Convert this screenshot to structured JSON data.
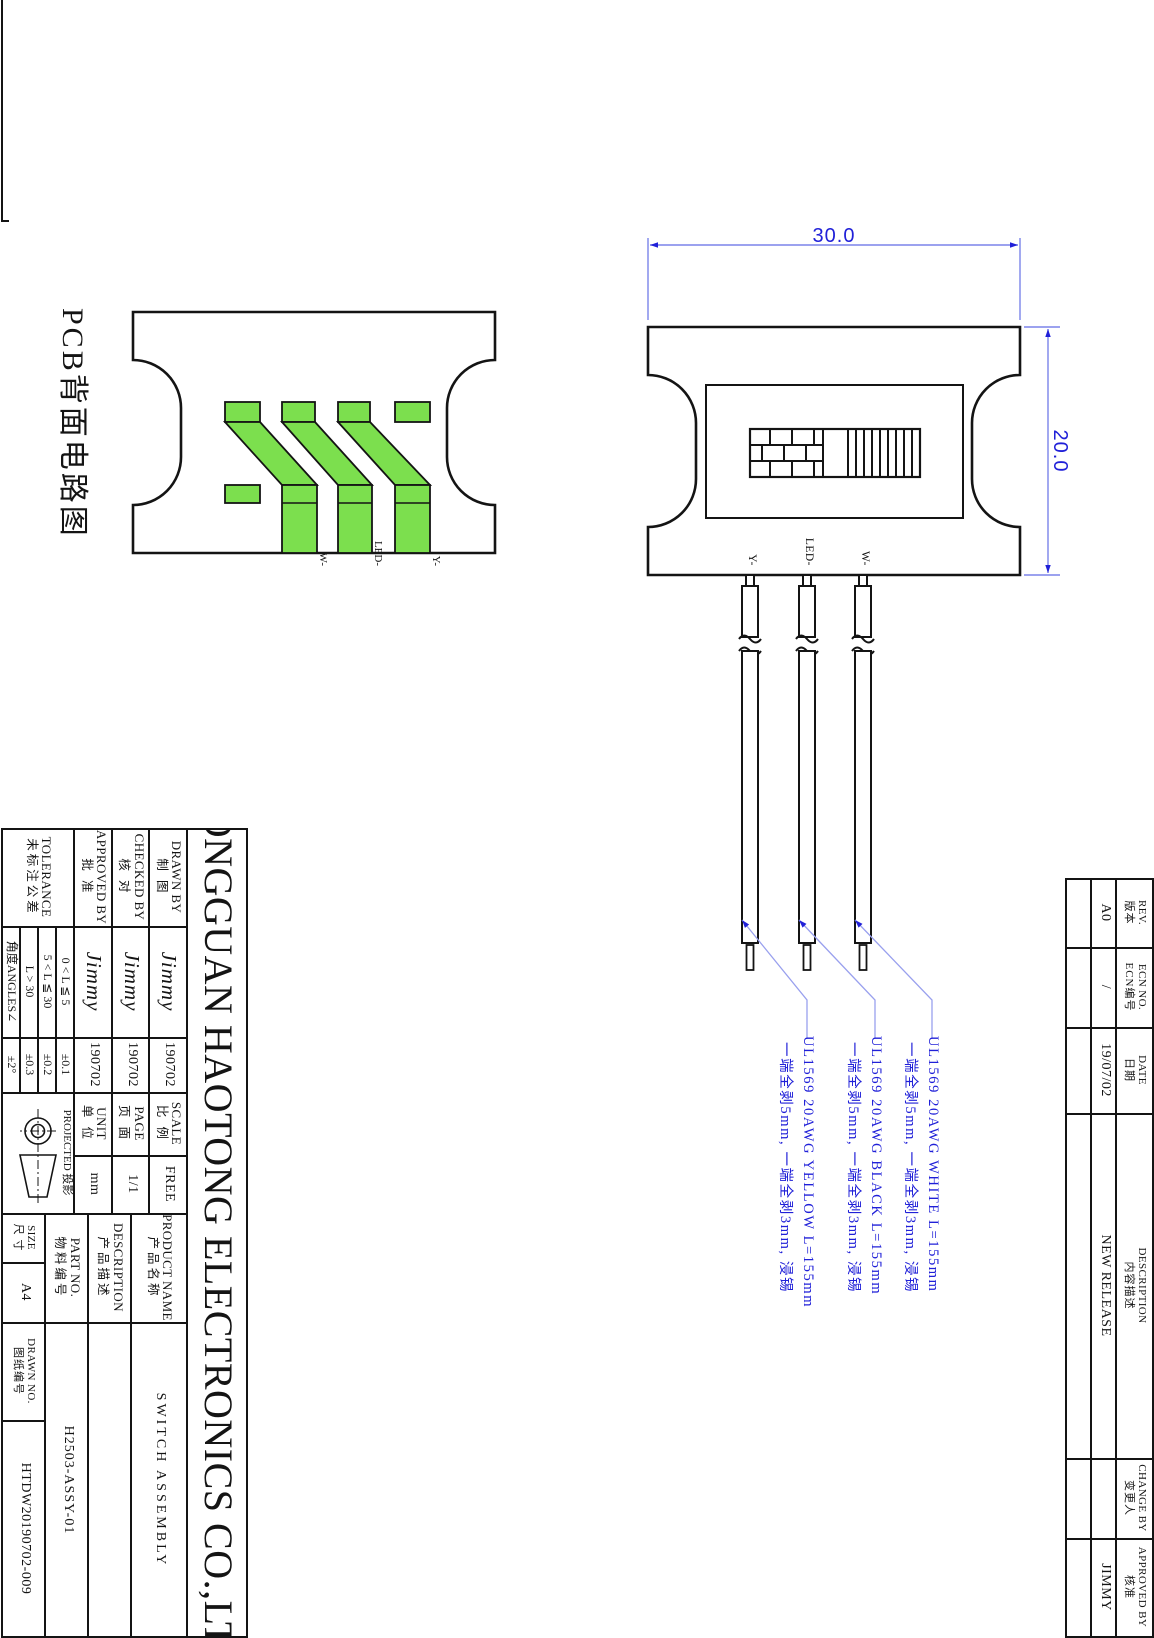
{
  "colors": {
    "line": "#141414",
    "dim_blue": "#2020d8",
    "leader_blue": "#99a0ee",
    "trace_green": "#7cdf4e",
    "paper": "#ffffff"
  },
  "views": {
    "pcb": {
      "title": "PCB背面电路图",
      "pad_labels": {
        "y": "Y-",
        "led": "LED-",
        "w": "W-"
      }
    },
    "switch": {
      "dim_width_mm": "20.0",
      "dim_height_mm": "30.0",
      "wire_labels": {
        "w": "W-",
        "led": "LED-",
        "y": "Y-"
      }
    }
  },
  "wire_notes": [
    {
      "spec": "UL1569 20AWG WHITE L=155mm",
      "process": "一端全剥5mm, 一端全剥3mm, 浸锡"
    },
    {
      "spec": "UL1569 20AWG BLACK L=155mm",
      "process": "一端全剥5mm, 一端全剥3mm, 浸锡"
    },
    {
      "spec": "UL1569 20AWG YELLOW L=155mm",
      "process": "一端全剥5mm, 一端全剥3mm, 浸锡"
    }
  ],
  "title_block": {
    "company": "DONGGUAN HAOTONG ELECTRONICS CO.,LTD.",
    "drawn_by": {
      "label_en": "DRAWN BY",
      "label_cn": "制 图",
      "signature": "Jimmy",
      "date": "190702"
    },
    "checked_by": {
      "label_en": "CHECKED BY",
      "label_cn": "核 对",
      "signature": "Jimmy",
      "date": "190702"
    },
    "approved_by": {
      "label_en": "APPROVED BY",
      "label_cn": "批 准",
      "signature": "Jimmy",
      "date": "190702"
    },
    "tolerance": {
      "label_en": "TOLERANCE",
      "label_cn": "未标注公差",
      "rows": [
        {
          "cond": "0 < L ≦ 5",
          "val": "±0.1"
        },
        {
          "cond": "5 < L ≦ 30",
          "val": "±0.2"
        },
        {
          "cond": "L > 30",
          "val": "±0.3"
        },
        {
          "cond": "角度ANGLES∠",
          "val": "±2°"
        }
      ]
    },
    "scale": {
      "label_en": "SCALE",
      "label_cn": "比 例",
      "value": "FREE"
    },
    "page": {
      "label_en": "PAGE",
      "label_cn": "页 面",
      "value": "1/1"
    },
    "unit": {
      "label_en": "UNIT",
      "label_cn": "单 位",
      "value": "mm"
    },
    "projected": {
      "label": "PROJECTED 投影"
    },
    "product_name": {
      "label_en": "PRODUCT NAME",
      "label_cn": "产品名称",
      "value": "SWITCH ASSEMBLY"
    },
    "description": {
      "label_en": "DESCRIPTION",
      "label_cn": "产品描述",
      "value": ""
    },
    "part_no": {
      "label_en": "PART NO.",
      "label_cn": "物料编号",
      "value": "H2503-ASSY-01"
    },
    "size": {
      "label_en": "SIZE",
      "label_cn": "尺 寸",
      "value": "A4"
    },
    "drawn_no": {
      "label_en": "DRAWN NO.",
      "label_cn": "图纸编号",
      "value": "HTDW20190702-009"
    }
  },
  "revision_table": {
    "headers": [
      {
        "en": "REV.",
        "cn": "版本"
      },
      {
        "en": "ECN NO.",
        "cn": "ECN编号"
      },
      {
        "en": "DATE",
        "cn": "日期"
      },
      {
        "en": "DESCRIPTION",
        "cn": "内容描述"
      },
      {
        "en": "CHANGE BY",
        "cn": "变更人"
      },
      {
        "en": "APPROVED BY",
        "cn": "核准"
      }
    ],
    "row": {
      "rev": "A0",
      "ecn": "/",
      "date": "19/07/02",
      "description": "NEW RELEASE",
      "change_by": "",
      "approved_by": "JIMMY"
    }
  }
}
